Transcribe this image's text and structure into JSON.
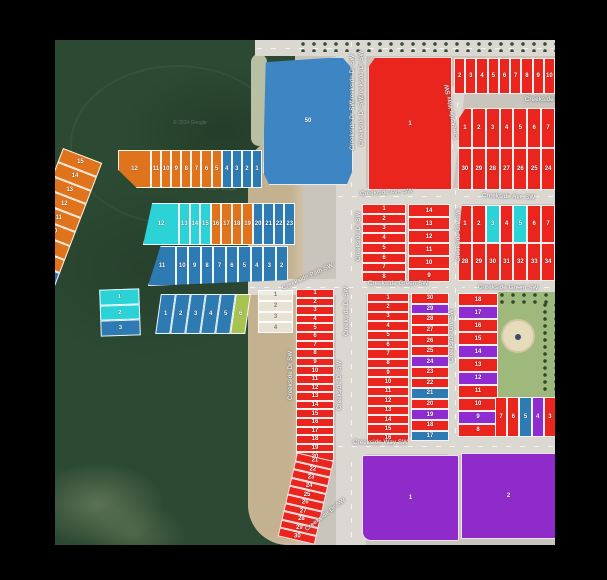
{
  "watermark": "© 2024 Google",
  "streets": {
    "ave": "Creekside Ave SW",
    "green": "Creekside Green SW",
    "dr": "Creekside Dr SW",
    "grv": "Creekside Grv SW",
    "way": "Creekside Way SW",
    "path": "Creekside Path SW"
  },
  "colors": {
    "red": "#e9251d",
    "orange": "#e0741c",
    "blue": "#2e7ab3",
    "cyan": "#2cd3d6",
    "purple": "#8e2cd2",
    "green": "#a7c352",
    "white": "rgba(244,243,238,0.74)",
    "pond_blue": "#3e86c3",
    "south_purple": "#8f2cc9"
  },
  "big_lots": {
    "pond_lot": "50",
    "ne_large_lot": "1",
    "south_parcel_1": "1",
    "south_parcel_2": "2"
  },
  "groups": {
    "diag_strip": {
      "lots": [
        {
          "n": "15",
          "c": "orange"
        },
        {
          "n": "14",
          "c": "orange"
        },
        {
          "n": "13",
          "c": "orange"
        },
        {
          "n": "12",
          "c": "orange"
        },
        {
          "n": "11",
          "c": "orange"
        },
        {
          "n": "10",
          "c": "orange"
        },
        {
          "n": "9",
          "c": "orange"
        },
        {
          "n": "8",
          "c": "orange"
        },
        {
          "n": "7",
          "c": "blue"
        },
        {
          "n": "6",
          "c": "blue"
        }
      ]
    },
    "row_north": {
      "lots": [
        {
          "n": "12",
          "c": "orange"
        },
        {
          "n": "11",
          "c": "orange"
        },
        {
          "n": "10",
          "c": "orange"
        },
        {
          "n": "9",
          "c": "orange"
        },
        {
          "n": "8",
          "c": "orange"
        },
        {
          "n": "7",
          "c": "orange"
        },
        {
          "n": "6",
          "c": "orange"
        },
        {
          "n": "5",
          "c": "orange"
        },
        {
          "n": "4",
          "c": "blue"
        },
        {
          "n": "3",
          "c": "blue"
        },
        {
          "n": "2",
          "c": "blue"
        },
        {
          "n": "1",
          "c": "blue"
        }
      ]
    },
    "row_mid": {
      "lots": [
        {
          "n": "12",
          "c": "cyan"
        },
        {
          "n": "13",
          "c": "cyan"
        },
        {
          "n": "14",
          "c": "cyan"
        },
        {
          "n": "15",
          "c": "cyan"
        },
        {
          "n": "16",
          "c": "orange"
        },
        {
          "n": "17",
          "c": "orange"
        },
        {
          "n": "18",
          "c": "orange"
        },
        {
          "n": "19",
          "c": "orange"
        },
        {
          "n": "20",
          "c": "blue"
        },
        {
          "n": "21",
          "c": "blue"
        },
        {
          "n": "22",
          "c": "blue"
        },
        {
          "n": "23",
          "c": "blue"
        }
      ]
    },
    "row_south": {
      "lots": [
        {
          "n": "11",
          "c": "blue"
        },
        {
          "n": "10",
          "c": "blue"
        },
        {
          "n": "9",
          "c": "blue"
        },
        {
          "n": "8",
          "c": "blue"
        },
        {
          "n": "7",
          "c": "blue"
        },
        {
          "n": "6",
          "c": "blue"
        },
        {
          "n": "5",
          "c": "blue"
        },
        {
          "n": "4",
          "c": "blue"
        },
        {
          "n": "3",
          "c": "blue"
        },
        {
          "n": "2",
          "c": "blue"
        }
      ]
    },
    "small_stack": {
      "lots": [
        {
          "n": "1",
          "c": "cyan"
        },
        {
          "n": "2",
          "c": "cyan"
        },
        {
          "n": "3",
          "c": "blue"
        }
      ]
    },
    "small_row": {
      "lots": [
        {
          "n": "1",
          "c": "blue"
        },
        {
          "n": "2",
          "c": "blue"
        },
        {
          "n": "3",
          "c": "blue"
        },
        {
          "n": "4",
          "c": "blue"
        },
        {
          "n": "5",
          "c": "blue"
        },
        {
          "n": "6",
          "c": "green"
        }
      ]
    },
    "white_stack": {
      "lots": [
        {
          "n": "1",
          "c": "white"
        },
        {
          "n": "2",
          "c": "white"
        },
        {
          "n": "3",
          "c": "white"
        },
        {
          "n": "4",
          "c": "white"
        }
      ]
    },
    "strip_upper": {
      "lots": [
        {
          "n": "1",
          "c": "red"
        },
        {
          "n": "2",
          "c": "red"
        },
        {
          "n": "3",
          "c": "red"
        },
        {
          "n": "4",
          "c": "red"
        },
        {
          "n": "5",
          "c": "red"
        },
        {
          "n": "6",
          "c": "red"
        },
        {
          "n": "7",
          "c": "red"
        },
        {
          "n": "8",
          "c": "red"
        },
        {
          "n": "9",
          "c": "red"
        },
        {
          "n": "10",
          "c": "red"
        },
        {
          "n": "11",
          "c": "red"
        },
        {
          "n": "12",
          "c": "red"
        },
        {
          "n": "13",
          "c": "red"
        },
        {
          "n": "14",
          "c": "red"
        },
        {
          "n": "15",
          "c": "red"
        },
        {
          "n": "16",
          "c": "red"
        },
        {
          "n": "17",
          "c": "red"
        },
        {
          "n": "18",
          "c": "red"
        },
        {
          "n": "19",
          "c": "red"
        },
        {
          "n": "20",
          "c": "red"
        }
      ]
    },
    "strip_lower": {
      "lots": [
        {
          "n": "21",
          "c": "red"
        },
        {
          "n": "22",
          "c": "red"
        },
        {
          "n": "23",
          "c": "red"
        },
        {
          "n": "24",
          "c": "red"
        },
        {
          "n": "25",
          "c": "red"
        },
        {
          "n": "26",
          "c": "red"
        },
        {
          "n": "27",
          "c": "red"
        },
        {
          "n": "28",
          "c": "red"
        },
        {
          "n": "29",
          "c": "red"
        },
        {
          "n": "30",
          "c": "red"
        }
      ]
    },
    "ne_row": {
      "lots": [
        {
          "n": "2",
          "c": "red"
        },
        {
          "n": "3",
          "c": "red"
        },
        {
          "n": "4",
          "c": "red"
        },
        {
          "n": "5",
          "c": "red"
        },
        {
          "n": "6",
          "c": "red"
        },
        {
          "n": "7",
          "c": "red"
        },
        {
          "n": "8",
          "c": "red"
        },
        {
          "n": "9",
          "c": "red"
        },
        {
          "n": "10",
          "c": "red"
        }
      ]
    },
    "ne_block_row1": {
      "lots": [
        {
          "n": "1",
          "c": "red"
        },
        {
          "n": "2",
          "c": "red"
        },
        {
          "n": "3",
          "c": "red"
        },
        {
          "n": "4",
          "c": "red"
        },
        {
          "n": "5",
          "c": "red"
        },
        {
          "n": "6",
          "c": "red"
        },
        {
          "n": "7",
          "c": "red"
        }
      ]
    },
    "ne_block_row2": {
      "lots": [
        {
          "n": "30",
          "c": "red"
        },
        {
          "n": "29",
          "c": "red"
        },
        {
          "n": "28",
          "c": "red"
        },
        {
          "n": "27",
          "c": "red"
        },
        {
          "n": "26",
          "c": "red"
        },
        {
          "n": "25",
          "c": "red"
        },
        {
          "n": "24",
          "c": "red"
        }
      ]
    },
    "e_block_row1": {
      "lots": [
        {
          "n": "1",
          "c": "red"
        },
        {
          "n": "2",
          "c": "red"
        },
        {
          "n": "3",
          "c": "cyan"
        },
        {
          "n": "4",
          "c": "red"
        },
        {
          "n": "5",
          "c": "cyan"
        },
        {
          "n": "6",
          "c": "red"
        },
        {
          "n": "7",
          "c": "red"
        }
      ]
    },
    "e_block_row2": {
      "lots": [
        {
          "n": "28",
          "c": "red"
        },
        {
          "n": "29",
          "c": "red"
        },
        {
          "n": "30",
          "c": "red"
        },
        {
          "n": "31",
          "c": "red"
        },
        {
          "n": "32",
          "c": "red"
        },
        {
          "n": "33",
          "c": "red"
        },
        {
          "n": "34",
          "c": "red"
        }
      ]
    },
    "mid_block_col1": {
      "lots": [
        {
          "n": "1",
          "c": "red"
        },
        {
          "n": "2",
          "c": "red"
        },
        {
          "n": "3",
          "c": "red"
        },
        {
          "n": "4",
          "c": "red"
        },
        {
          "n": "5",
          "c": "red"
        },
        {
          "n": "6",
          "c": "red"
        },
        {
          "n": "7",
          "c": "red"
        },
        {
          "n": "8",
          "c": "red"
        }
      ]
    },
    "mid_block_col2": {
      "lots": [
        {
          "n": "14",
          "c": "red"
        },
        {
          "n": "13",
          "c": "red"
        },
        {
          "n": "12",
          "c": "red"
        },
        {
          "n": "11",
          "c": "red"
        },
        {
          "n": "10",
          "c": "red"
        },
        {
          "n": "9",
          "c": "red"
        }
      ]
    },
    "s_block_col1": {
      "lots": [
        {
          "n": "1",
          "c": "red"
        },
        {
          "n": "2",
          "c": "red"
        },
        {
          "n": "3",
          "c": "red"
        },
        {
          "n": "4",
          "c": "red"
        },
        {
          "n": "5",
          "c": "red"
        },
        {
          "n": "6",
          "c": "red"
        },
        {
          "n": "7",
          "c": "red"
        },
        {
          "n": "8",
          "c": "red"
        },
        {
          "n": "9",
          "c": "red"
        },
        {
          "n": "10",
          "c": "red"
        },
        {
          "n": "11",
          "c": "red"
        },
        {
          "n": "12",
          "c": "red"
        },
        {
          "n": "13",
          "c": "red"
        },
        {
          "n": "14",
          "c": "red"
        },
        {
          "n": "15",
          "c": "red"
        },
        {
          "n": "16",
          "c": "red"
        }
      ]
    },
    "s_block_col2": {
      "lots": [
        {
          "n": "30",
          "c": "red"
        },
        {
          "n": "29",
          "c": "purple"
        },
        {
          "n": "28",
          "c": "red"
        },
        {
          "n": "27",
          "c": "red"
        },
        {
          "n": "26",
          "c": "red"
        },
        {
          "n": "25",
          "c": "red"
        },
        {
          "n": "24",
          "c": "purple"
        },
        {
          "n": "23",
          "c": "red"
        },
        {
          "n": "22",
          "c": "red"
        },
        {
          "n": "21",
          "c": "blue"
        },
        {
          "n": "20",
          "c": "red"
        },
        {
          "n": "19",
          "c": "purple"
        },
        {
          "n": "18",
          "c": "red"
        },
        {
          "n": "17",
          "c": "blue"
        }
      ]
    },
    "se_col": {
      "lots": [
        {
          "n": "18",
          "c": "red"
        },
        {
          "n": "17",
          "c": "purple"
        },
        {
          "n": "16",
          "c": "red"
        },
        {
          "n": "15",
          "c": "red"
        },
        {
          "n": "14",
          "c": "purple"
        },
        {
          "n": "13",
          "c": "red"
        },
        {
          "n": "12",
          "c": "purple"
        },
        {
          "n": "11",
          "c": "red"
        },
        {
          "n": "10",
          "c": "red"
        },
        {
          "n": "9",
          "c": "purple"
        },
        {
          "n": "8",
          "c": "red"
        }
      ]
    },
    "se_row": {
      "lots": [
        {
          "n": "7",
          "c": "red"
        },
        {
          "n": "6",
          "c": "red"
        },
        {
          "n": "5",
          "c": "blue"
        },
        {
          "n": "4",
          "c": "purple"
        },
        {
          "n": "3",
          "c": "red"
        }
      ]
    }
  }
}
